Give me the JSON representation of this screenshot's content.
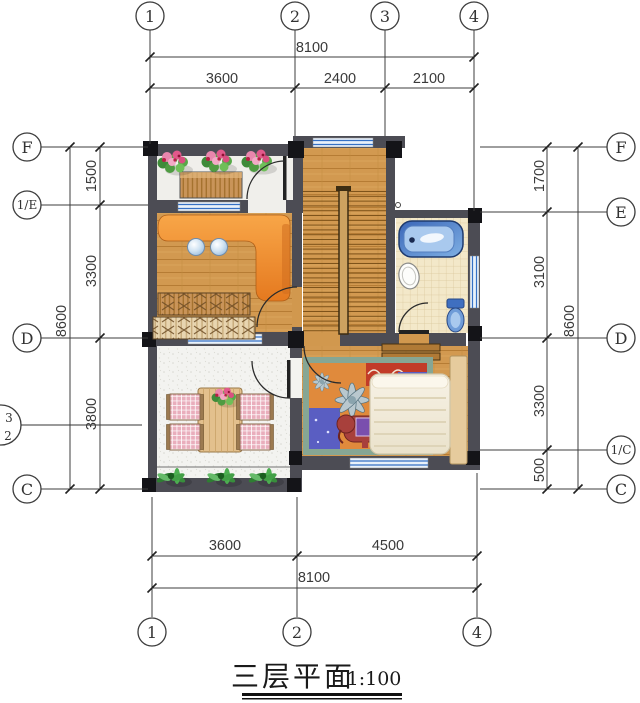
{
  "drawing": {
    "title": "三层平面",
    "scale_label": "1:100"
  },
  "axis_bubbles": {
    "top": [
      {
        "label": "1"
      },
      {
        "label": "2"
      },
      {
        "label": "3"
      },
      {
        "label": "4"
      }
    ],
    "bottom": [
      {
        "label": "1"
      },
      {
        "label": "2"
      },
      {
        "label": "4"
      }
    ],
    "left": [
      {
        "label": "F"
      },
      {
        "label": "1/E"
      },
      {
        "label": "D"
      },
      {
        "label": "C"
      }
    ],
    "left_partial": {
      "top": "3",
      "bottom": "2"
    },
    "right": [
      {
        "label": "F"
      },
      {
        "label": "E"
      },
      {
        "label": "D"
      },
      {
        "label": "1/C"
      },
      {
        "label": "C"
      }
    ]
  },
  "dimensions": {
    "top": {
      "total": "8100",
      "segments": [
        "3600",
        "2400",
        "2100"
      ]
    },
    "bottom": {
      "total": "8100",
      "segments": [
        "3600",
        "4500"
      ]
    },
    "left": {
      "total": "8600",
      "segments": [
        "1500",
        "3300",
        "3800"
      ]
    },
    "right": {
      "total": "8600",
      "segments": [
        "1700",
        "3100",
        "3300",
        "500"
      ]
    }
  },
  "colors": {
    "wall": "#4c4c54",
    "column": "#141418",
    "wood_floor": "#d1984e",
    "tile_floor": "#f3e8c9",
    "terrace_floor": "#f3f3f0",
    "window_blue": "#3570c4",
    "bathtub_blue": "#3f6fc0",
    "counter_orange": "#ee8a2e",
    "rug_orange": "#e08a3c",
    "rug_blue": "#5a5ec2",
    "plant_green": "#4caf50",
    "chair_pink": "#e9aebc",
    "dimension_line": "#3c3c3c"
  }
}
